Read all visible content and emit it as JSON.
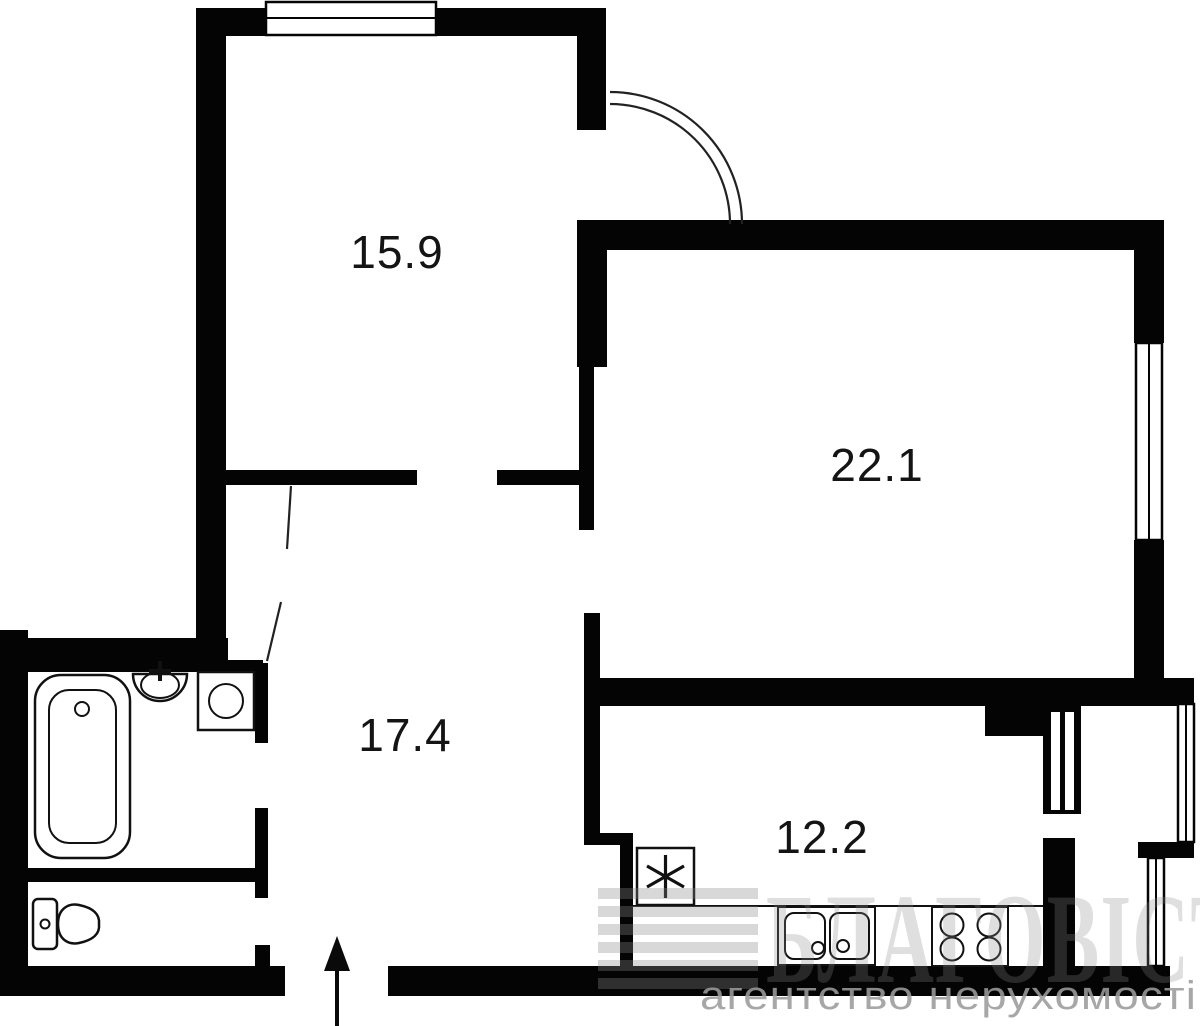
{
  "document": {
    "type": "apartment-floor-plan"
  },
  "rooms": [
    {
      "id": "room-top-left",
      "area_label": "15.9"
    },
    {
      "id": "room-right",
      "area_label": "22.1"
    },
    {
      "id": "hallway-center",
      "area_label": "17.4"
    },
    {
      "id": "kitchen-bottom",
      "area_label": "12.2"
    }
  ],
  "fixtures": [
    {
      "name": "bathtub"
    },
    {
      "name": "wash-basin"
    },
    {
      "name": "washing-machine"
    },
    {
      "name": "toilet"
    },
    {
      "name": "refrigerator"
    },
    {
      "name": "kitchen-sink"
    },
    {
      "name": "stove"
    }
  ],
  "features": [
    {
      "name": "entrance-arrow"
    },
    {
      "name": "door-swing-arc"
    },
    {
      "name": "window-top"
    },
    {
      "name": "window-right"
    },
    {
      "name": "window-kitchen-upper"
    },
    {
      "name": "window-kitchen-lower"
    },
    {
      "name": "vent-shaft"
    }
  ],
  "watermark": {
    "brand": "БЛАГОВІСТ",
    "subtitle": "агентство  нерухомості"
  },
  "colors": {
    "wall": "#040404",
    "background": "#ffffff",
    "label": "#141414",
    "watermark": "#8a8a8a"
  }
}
